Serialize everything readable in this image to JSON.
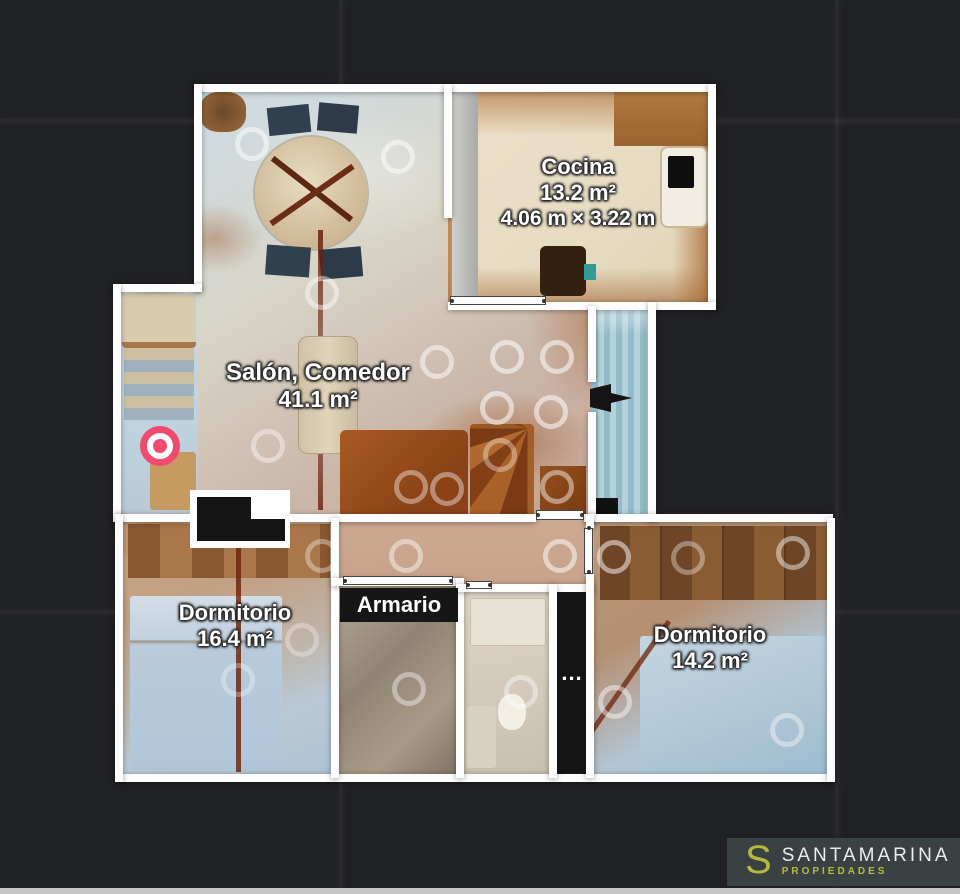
{
  "floorplan": {
    "rooms": [
      {
        "key": "cocina",
        "name": "Cocina",
        "area": "13.2 m²",
        "dimensions": "4.06 m × 3.22 m"
      },
      {
        "key": "salon_comedor",
        "name": "Salón, Comedor",
        "area": "41.1 m²"
      },
      {
        "key": "dormitorio_1",
        "name": "Dormitorio",
        "area": "16.4 m²"
      },
      {
        "key": "armario",
        "name": "Armario"
      },
      {
        "key": "dormitorio_2",
        "name": "Dormitorio",
        "area": "14.2 m²"
      },
      {
        "key": "unlabeled_truncated",
        "name": "..."
      }
    ],
    "marker_color": "#ee4b6e",
    "scan_ring_color": "#ffffff"
  },
  "branding": {
    "monogram": "S",
    "name": "SANTAMARINA",
    "tagline": "PROPIEDADES",
    "accent_color": "#b5ba3f"
  }
}
